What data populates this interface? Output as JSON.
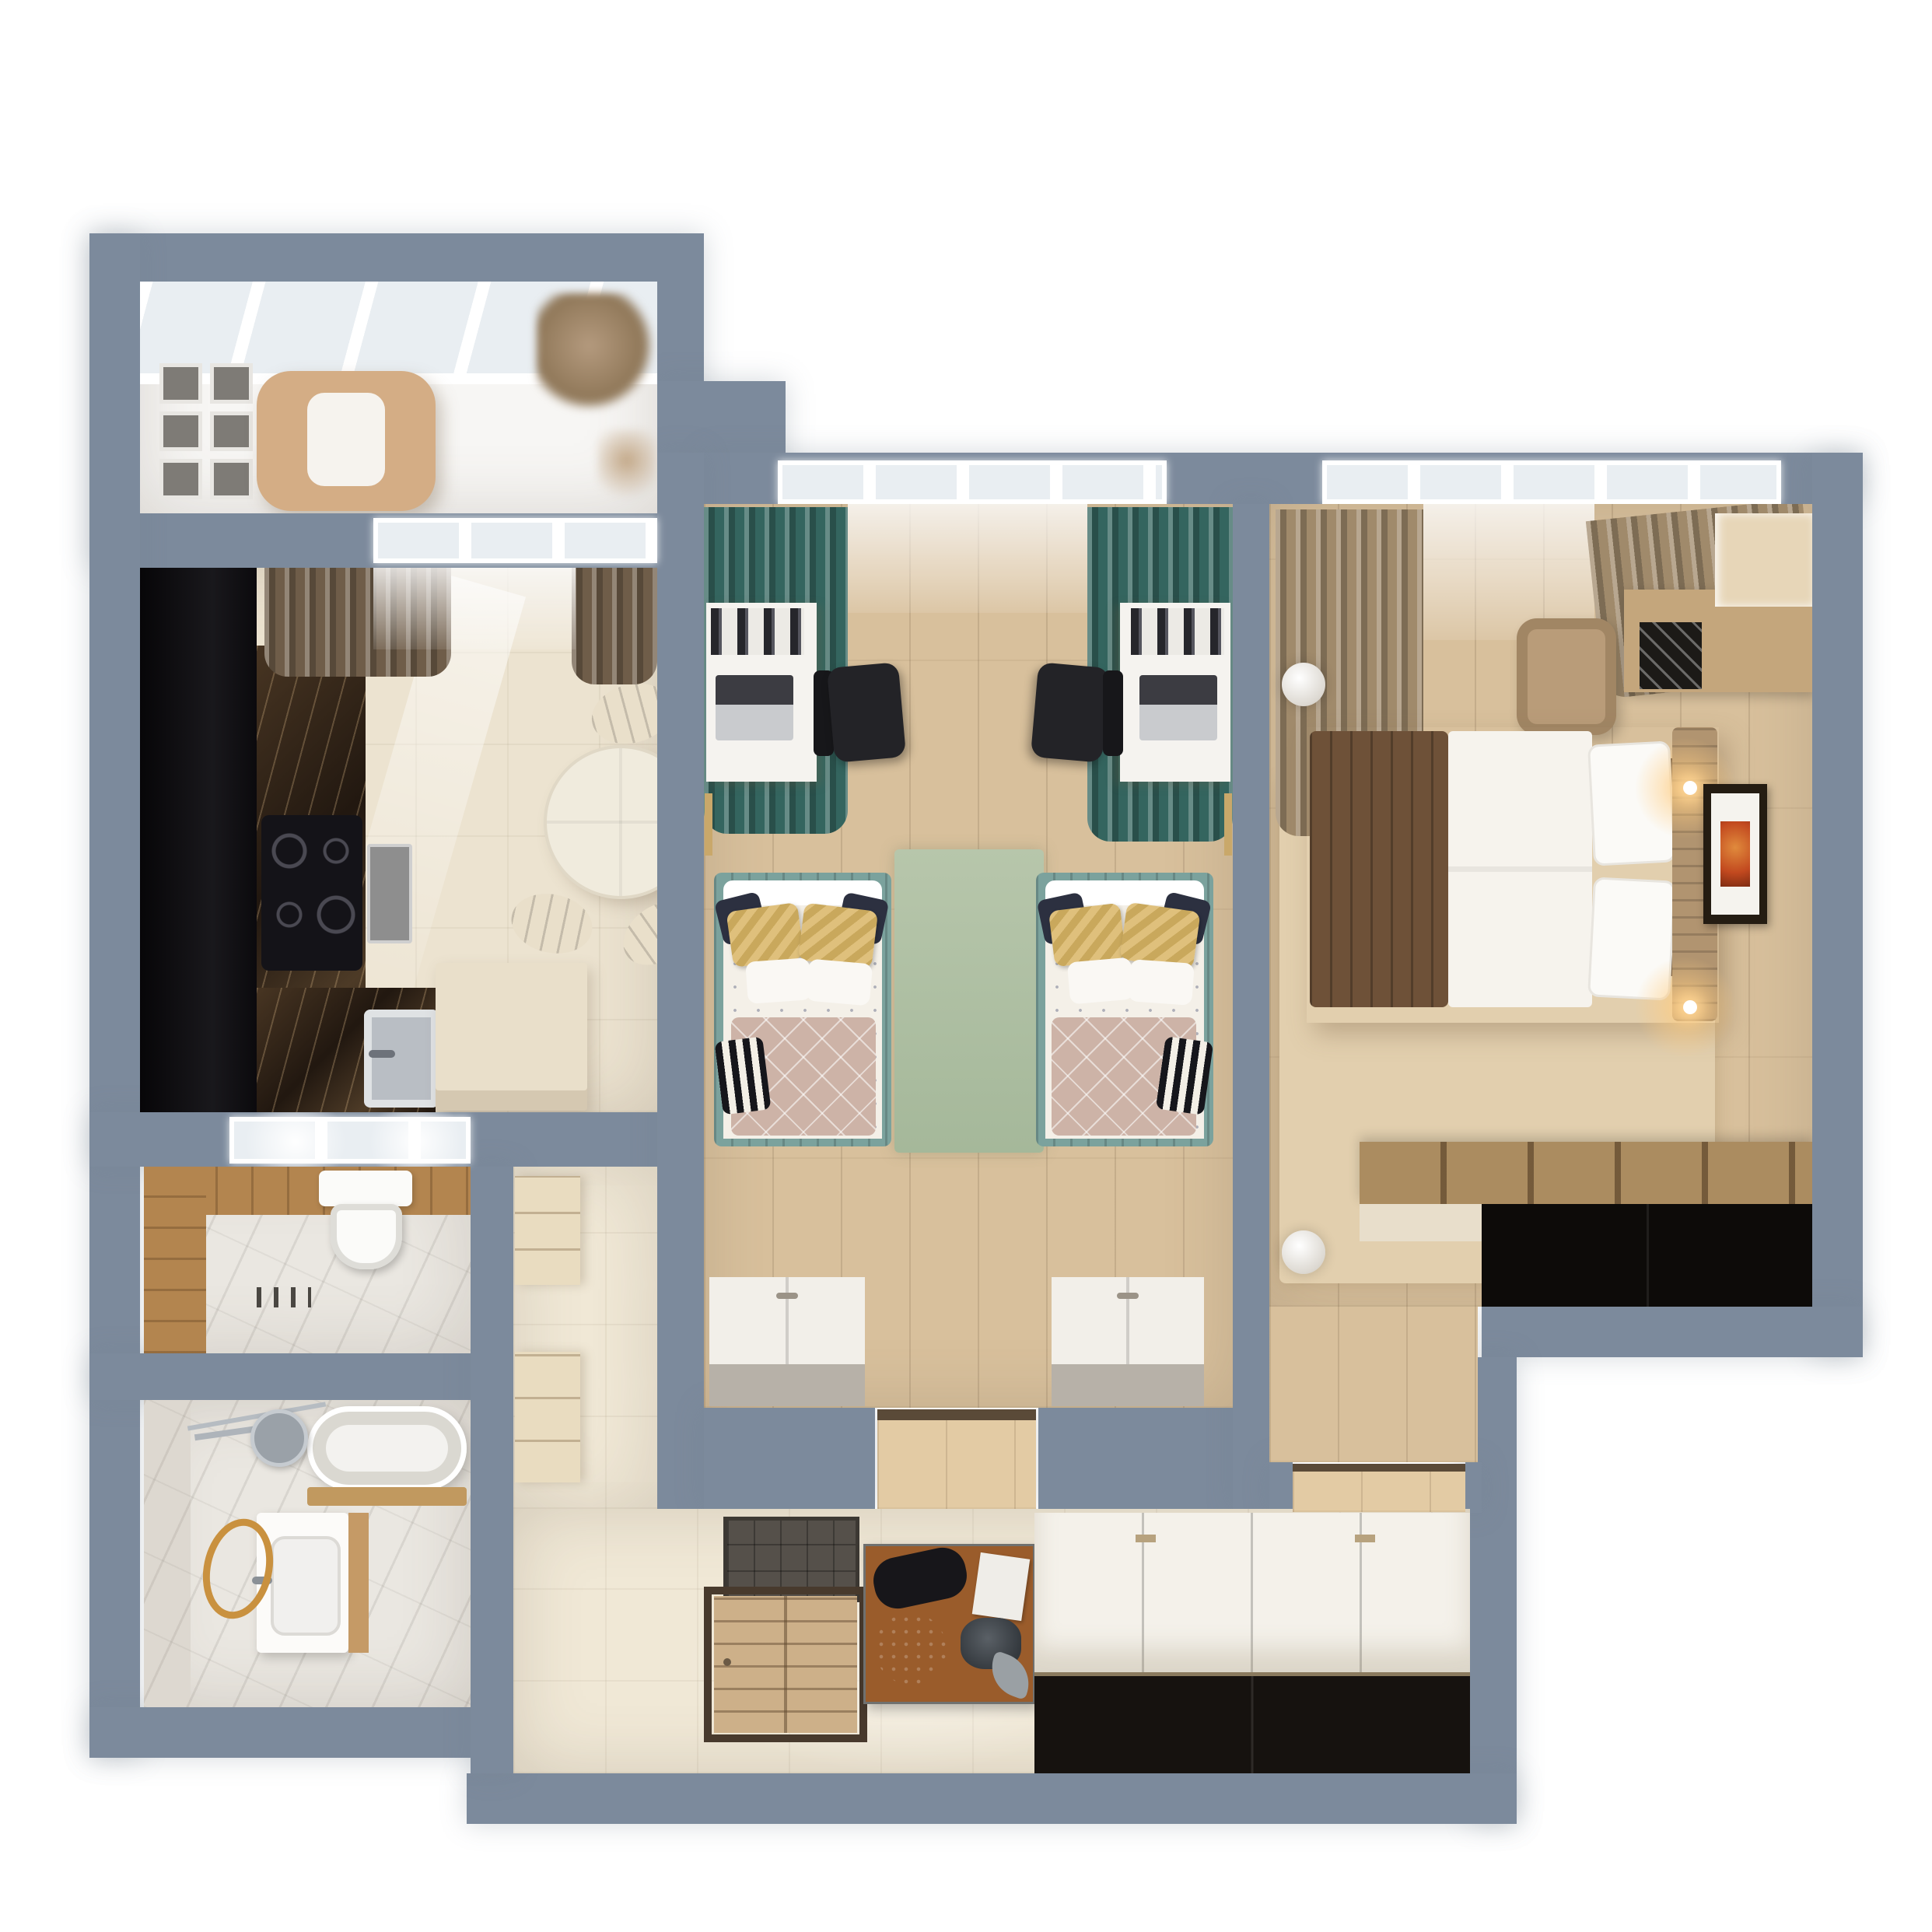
{
  "scene": {
    "type": "3d-floor-plan-top-view",
    "description": "Photoreal top-down render of a two-bedroom apartment with blue-gray cut walls on a white background",
    "visible_text": "none"
  },
  "colors": {
    "wall": "#7c8a9c",
    "outside": "#ffffff",
    "balcony_floor": "#f7f6f4",
    "glass": "#e9eef2",
    "kitchen_floor": "#ece3d0",
    "black_cabinet": "#0c0b0e",
    "steel": "#b9bec4",
    "cream": "#e9dfca",
    "table_cream": "#f0ebdd",
    "wood_floor": "#d8c09c",
    "rug_sage": "#b7c6ab",
    "rug_beige": "#e2cfae",
    "teal": "#34655f",
    "teal_frame": "#7ba29d",
    "tan_curtain": "#a08a6b",
    "brown_curtain": "#6f5d49",
    "bed_white": "#f4f0e8",
    "pillow_yellow": "#dfc07c",
    "pillow_navy": "#2c3040",
    "blanket_rose": "#cdb3a7",
    "throw_brown": "#6e5138",
    "headboard_tan": "#b19470",
    "chair_black": "#232327",
    "desk_white": "#f5f3ef",
    "marble_light": "#eae7e1",
    "wood_wall": "#b3854f",
    "gold": "#c9913f",
    "chrome": "#9aa1a8",
    "tile_floor": "#f0e8d6",
    "door_wood": "#cdb089",
    "mat_dark": "#55504a",
    "console_wood": "#9a5c2b",
    "wardrobe_top": "#f4f1ea",
    "wardrobe_front": "#16120f",
    "dresser_top": "#ab8c60",
    "dresser_front": "#0d0b09",
    "art_orange": "#c2491f",
    "cabinet_cream": "#e9dcc0",
    "white": "#ffffff",
    "toilet_white": "#fbfbf9",
    "island_cream": "#e9dfca",
    "sage_dark": "#a5b89a"
  },
  "rooms": [
    {
      "name": "balcony",
      "items": [
        "glazing-grid",
        "lounge-chair",
        "gallery-wall",
        "plants"
      ]
    },
    {
      "name": "kitchen",
      "items": [
        "tall-black-cabinet",
        "dark-marble-counter",
        "induction-cooktop",
        "oven",
        "sink",
        "island-counter",
        "round-dining-table",
        "dining-chairs",
        "curtains",
        "window"
      ]
    },
    {
      "name": "wc",
      "items": [
        "wall-hung-toilet",
        "wood-clad-walls",
        "marble-floor",
        "window",
        "floor-drain"
      ]
    },
    {
      "name": "bathroom",
      "items": [
        "bathtub",
        "vanity-with-sink",
        "shower-head",
        "shower-rail",
        "gold-towel-ring",
        "marble-walls"
      ]
    },
    {
      "name": "corridor",
      "items": [
        "tall-storage-cabinets",
        "tiled-floor"
      ]
    },
    {
      "name": "hallway",
      "items": [
        "entry-door",
        "doormat",
        "shoe-console",
        "sliding-wardrobe",
        "tiled-floor"
      ]
    },
    {
      "name": "kids-bedroom",
      "items": [
        "window",
        "teal-curtains",
        "two-desks",
        "two-laptops",
        "two-office-chairs",
        "twin-bed-left",
        "twin-bed-right",
        "sage-rug",
        "two-low-cabinets",
        "door-opening"
      ]
    },
    {
      "name": "master-bedroom",
      "items": [
        "window",
        "tan-curtains",
        "double-bed",
        "headboard",
        "wall-sconces",
        "framed-picture",
        "armchair",
        "shelf-console",
        "pendant-lamps",
        "beige-rug",
        "low-dresser",
        "door-opening"
      ]
    }
  ]
}
